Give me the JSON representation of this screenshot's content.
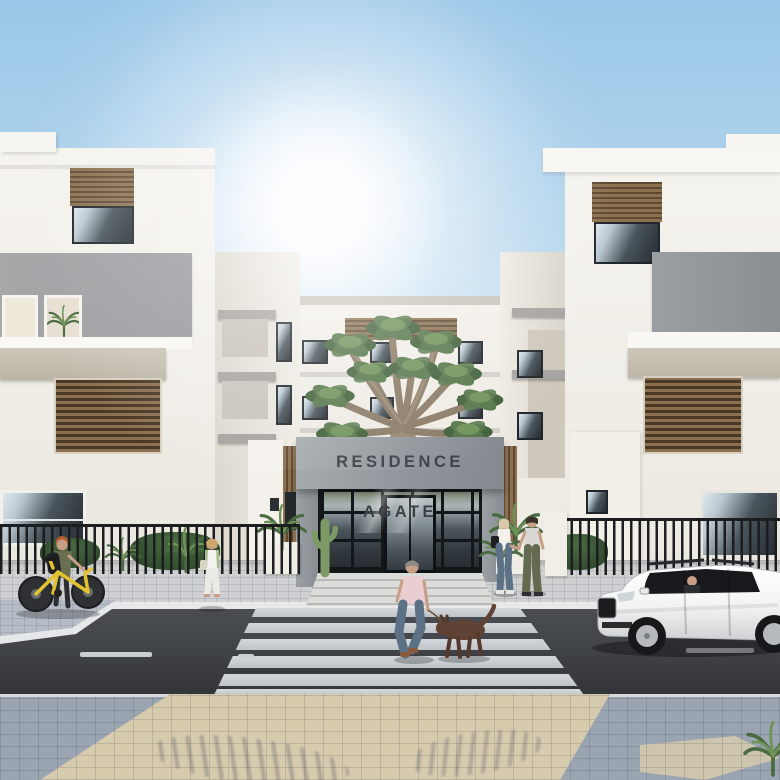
{
  "scene": {
    "sign_text": "RESIDENCE AGATE",
    "setting": "street-level exterior rendering of a modern white residential complex under a sunny blue sky",
    "objects": [
      "left residential building with wood louvers",
      "right residential building with wood louvers",
      "central building with entrance portal",
      "concrete canopy sign",
      "glass entrance doors with steps",
      "dragon tree",
      "black metal fence with plants",
      "zebra crosswalk",
      "asphalt street with dashed lane lines",
      "paved sidewalk foreground",
      "white station wagon with driver",
      "man in pink shirt walking a brown dog",
      "cyclist pushing a yellow bicycle",
      "woman walking in white trousers",
      "couple holding hands",
      "sun glare"
    ]
  },
  "palette": {
    "sky_top": "#9ac7e8",
    "sky_horizon": "#edf5fa",
    "wall": "#f3f1eb",
    "wall_shade": "#e4dfd6",
    "cornice": "#c9c5bc",
    "gray_band": "#9fa2a6",
    "gray_band_dark": "#8e9297",
    "beige_band": "#c6beb0",
    "wood": "#8c7050",
    "wood_dark": "#5e4933",
    "louver_frame": "#d8d1c3",
    "sign_bg": "#949a9f",
    "sign_bg_dark": "#81878c",
    "sign_text": "#3b4147",
    "fence": "#1b1d1f",
    "walkway": "#cfd0d1",
    "curb": "#e8e9ea",
    "asphalt": "#45484c",
    "asphalt_dark": "#323437",
    "stripe": "#ccd1d6",
    "island": "#b6bcc5",
    "paver_gray": "#9ba4b1",
    "paver_beige": "#d7cbae",
    "trunk": "#988873",
    "branch": "#8a7a66",
    "leaf": "#55774a",
    "leaf_light": "#6f9259",
    "leaf_dark": "#41603a",
    "plant": "#4a6b41",
    "bike_yellow": "#e3c42f",
    "skin": "#c79e86",
    "shirt_pink": "#e9cdd1",
    "jeans": "#5c7086",
    "olive": "#6a6f52",
    "dog": "#5f4233",
    "car_body": "#f5f5f4"
  }
}
